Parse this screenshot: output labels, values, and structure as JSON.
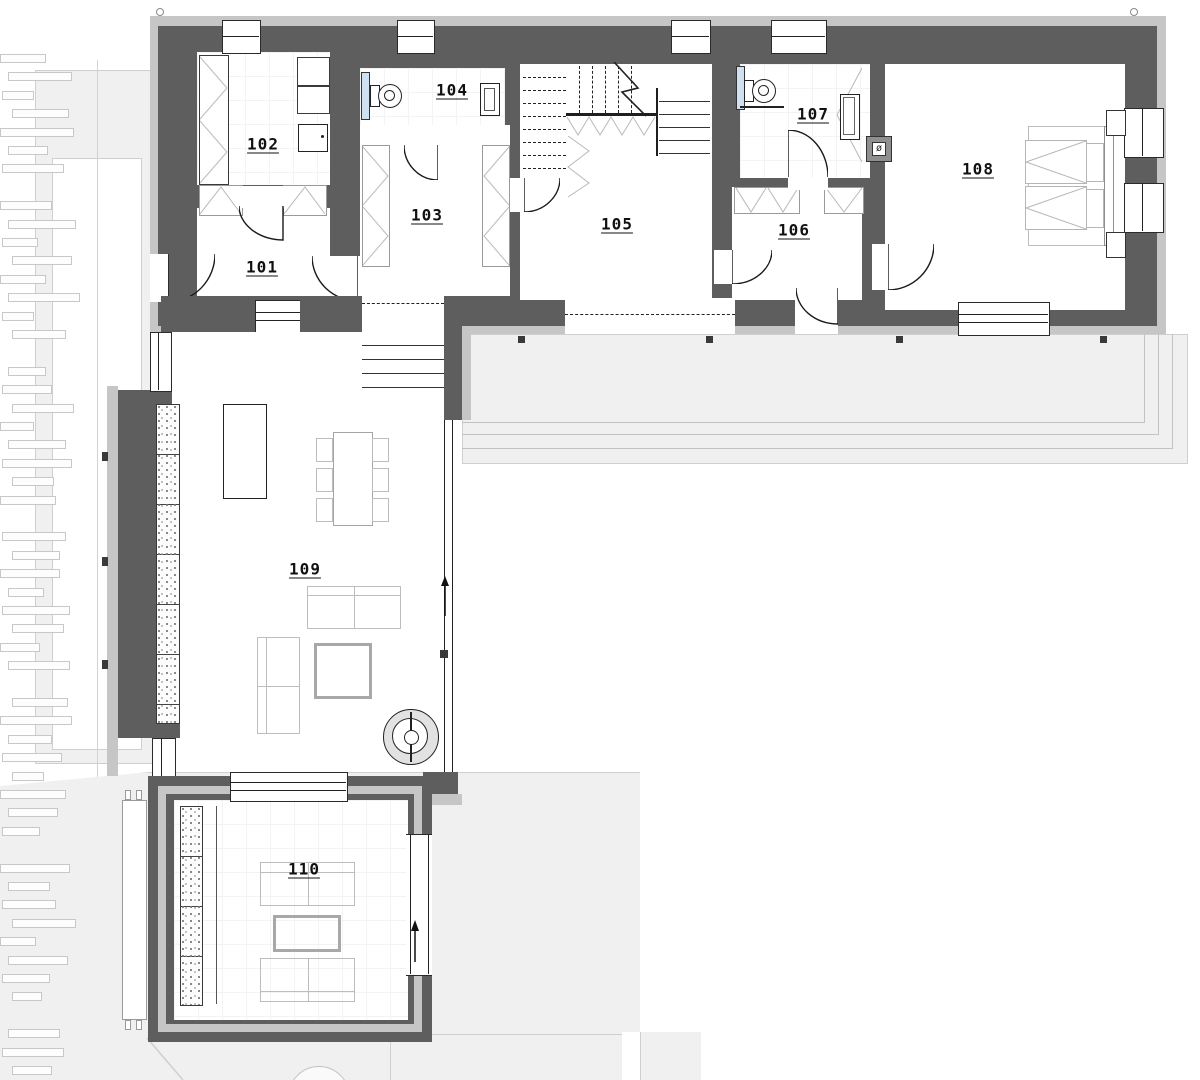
{
  "plan": {
    "title": "ground-floor-plan",
    "rooms": [
      {
        "id": "room-101",
        "label": "101"
      },
      {
        "id": "room-102",
        "label": "102"
      },
      {
        "id": "room-103",
        "label": "103"
      },
      {
        "id": "room-104",
        "label": "104"
      },
      {
        "id": "room-105",
        "label": "105"
      },
      {
        "id": "room-106",
        "label": "106"
      },
      {
        "id": "room-107",
        "label": "107"
      },
      {
        "id": "room-108",
        "label": "108"
      },
      {
        "id": "room-109",
        "label": "109"
      },
      {
        "id": "room-110",
        "label": "110"
      }
    ],
    "symbols": {
      "chimney": "ø"
    },
    "colors": {
      "wall": "#5e5e5e",
      "cladding": "#c6c6c6",
      "terrain": "#f0f0f0",
      "terrain_line": "#cfcfcf",
      "furniture_line": "#bdbdbd",
      "glazing": "#cfe1f0",
      "drawing_line": "#1f1f1f"
    }
  }
}
